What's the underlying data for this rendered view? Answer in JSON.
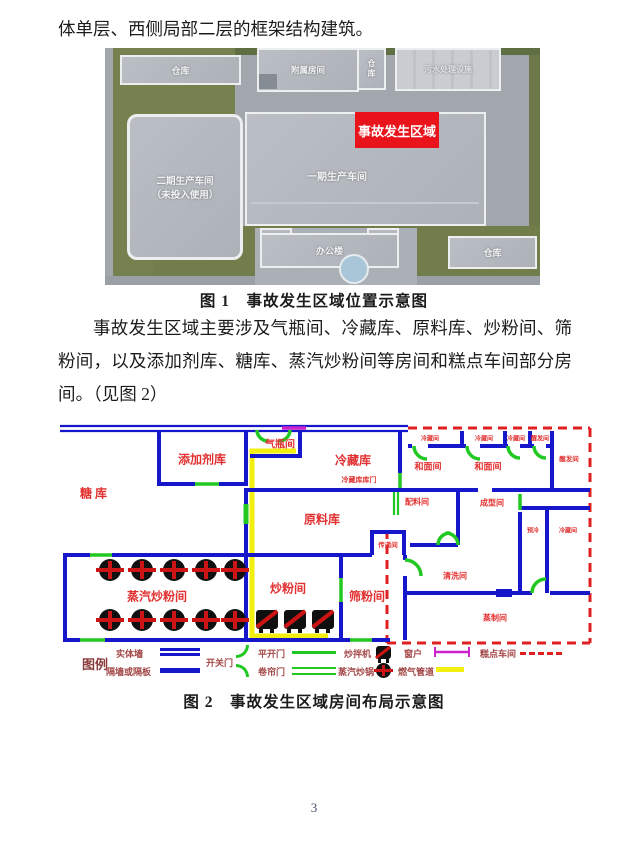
{
  "page": {
    "number": "3"
  },
  "intro_text": "体单层、西侧局部二层的框架结构建筑。",
  "paragraph": "事故发生区域主要涉及气瓶间、冷藏库、原料库、炒粉间、筛粉间，以及添加剂库、糖库、蒸汽炒粉间等房间和糕点车间部分房间。（见图 2）",
  "figure1": {
    "caption": "图 1　事故发生区域位置示意图",
    "labels": {
      "warehouse_tl": "仓库",
      "attached_rooms": "附属房间",
      "warehouse_small": "仓库",
      "sewage": "污水处理设施",
      "accident_area": "事故发生区域",
      "phase2_line1": "二期生产车间",
      "phase2_line2": "（未投入使用）",
      "phase1": "一期生产车间",
      "office": "办公楼",
      "warehouse_br": "仓库"
    },
    "colors": {
      "accident_red": "#e8131b",
      "grass": "#75814e",
      "concrete": "#a2a7ae",
      "building": "#b5b9bf"
    }
  },
  "figure2": {
    "caption": "图 2　事故发生区域房间布局示意图",
    "rooms": {
      "sugar": "糖库",
      "additive": "添加剂库",
      "cylinder": "气瓶间",
      "cold_storage": "冷藏库",
      "cold_storage_door": "冷藏库库门",
      "raw_material": "原料库",
      "steam_fry": "蒸汽炒粉间",
      "fry": "炒粉间",
      "sieve": "筛粉间",
      "transfer": "传递间",
      "cleaning": "清洗间",
      "steaming": "蒸制间",
      "batching": "配料间",
      "forming": "成型间",
      "dough1": "和面间",
      "dough2": "和面间",
      "cold1": "冷藏间",
      "cold2": "冷藏间",
      "cold3": "冷藏间",
      "proof1": "醒发间",
      "proof2": "醒发间",
      "precool": "预冷",
      "cold4": "冷藏间"
    },
    "legend": {
      "title": "图例",
      "solid_wall": "实体墙",
      "partition": "隔墙或隔板",
      "swing_door": "开关门",
      "hinged_door": "平开门",
      "shutter_door": "卷帘门",
      "mixer": "炒拌机",
      "steam_wok": "蒸汽炒锅",
      "window": "窗户",
      "gas_pipe": "燃气管道",
      "cake_workshop": "糕点车间"
    },
    "colors": {
      "wall": "#1616cb",
      "door": "#22c822",
      "window": "#cc22cc",
      "pipe": "#f2ef10",
      "boundary": "#e02020",
      "label": "#e23030"
    }
  }
}
